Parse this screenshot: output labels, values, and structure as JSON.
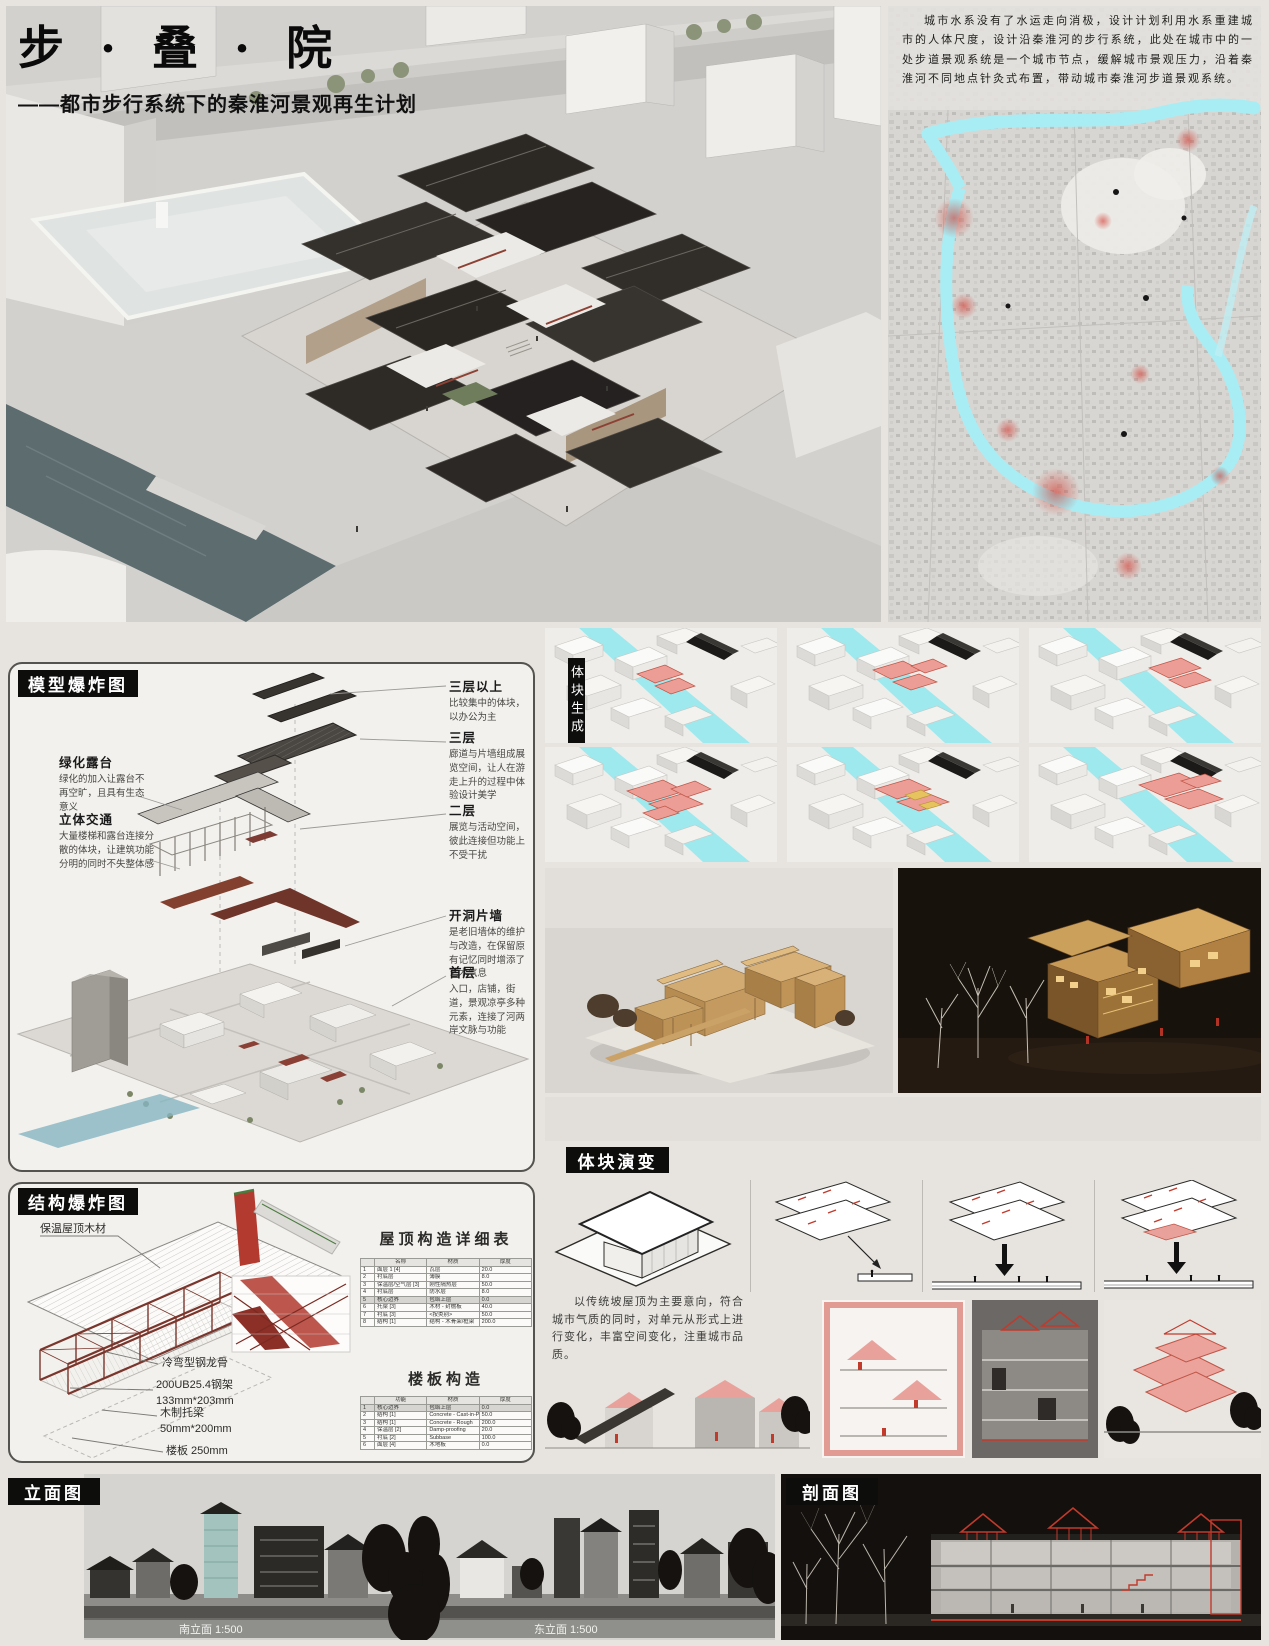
{
  "header": {
    "title": "步 · 叠 · 院",
    "subtitle": "——都市步行系统下的秦淮河景观再生计划"
  },
  "site": {
    "intro": "城市水系没有了水运走向消极，设计计划利用水系重建城市的人体尺度，设计沿秦淮河的步行系统，此处在城市中的一处步道景观系统是一个城市节点，缓解城市景观压力，沿着秦淮河不同地点针灸式布置，带动城市秦淮河步道景观系统。"
  },
  "exploded_model": {
    "title": "模型爆炸图",
    "left_labels": [
      {
        "title": "绿化露台",
        "desc": "绿化的加入让露台不再空旷，且具有生态意义"
      },
      {
        "title": "立体交通",
        "desc": "大量楼梯和露台连接分散的体块，让建筑功能分明的同时不失整体感"
      }
    ],
    "right_labels": [
      {
        "title": "三层以上",
        "desc": "比较集中的体块，以办公为主"
      },
      {
        "title": "三层",
        "desc": "廊道与片墙组成展览空间，让人在游走上升的过程中体验设计美学"
      },
      {
        "title": "二层",
        "desc": "展览与活动空间，彼此连接但功能上不受干扰"
      },
      {
        "title": "开洞片墙",
        "desc": "是老旧墙体的维护与改造，在保留原有记忆同时增添了艺术气息"
      },
      {
        "title": "首层",
        "desc": "入口，店铺，街道，景观凉亭多种元素，连接了河两岸文脉与功能"
      }
    ]
  },
  "massing_generation": {
    "title": "体块生成"
  },
  "massing_evolution": {
    "title": "体块演变",
    "note": "以传统坡屋顶为主要意向，符合城市气质的同时，对单元从形式上进行变化，丰富空间变化，注重城市品质。"
  },
  "structure": {
    "title": "结构爆炸图",
    "labels": {
      "roof_wood": "保温屋顶木材",
      "keel": "冷弯型钢龙骨",
      "frame_line1": "200UB25.4钢架",
      "frame_line2": "133mm*203mm",
      "joist_line1": "木制托梁",
      "joist_line2": "50mm*200mm",
      "slab": "楼板 250mm"
    },
    "roof_table": {
      "title": "屋顶构造详细表",
      "columns": [
        "",
        "名称",
        "材质",
        "厚度"
      ],
      "rows": [
        [
          "1",
          "面层 1 [4]",
          "瓦层",
          "20.0"
        ],
        [
          "2",
          "衬底层",
          "薄膜",
          "8.0"
        ],
        [
          "3",
          "保温层/空气层 [3]",
          "刚性隔热层",
          "50.0"
        ],
        [
          "4",
          "衬底层",
          "防水层",
          "8.0"
        ],
        [
          "5",
          "核心边界",
          "包络上层",
          "0.0"
        ],
        [
          "6",
          "托梁 [3]",
          "木材 - 封檐板",
          "40.0"
        ],
        [
          "7",
          "衬底 [3]",
          "<按类别>",
          "50.0"
        ],
        [
          "8",
          "结构 [1]",
          "结构 - 木骨架/框架",
          "200.0"
        ]
      ]
    },
    "floor_table": {
      "title": "楼板构造",
      "columns": [
        "",
        "功能",
        "材质",
        "厚度"
      ],
      "rows": [
        [
          "1",
          "核心边界",
          "包络上层",
          "0.0"
        ],
        [
          "2",
          "结构 [1]",
          "Concrete - Cast-in-Place",
          "50.0"
        ],
        [
          "3",
          "结构 [1]",
          "Concrete - Rough",
          "200.0"
        ],
        [
          "4",
          "保温层 [2]",
          "Damp-proofing",
          "20.0"
        ],
        [
          "5",
          "衬底 [2]",
          "Subbase",
          "100.0"
        ],
        [
          "6",
          "面层 [4]",
          "木地板",
          "0.0"
        ]
      ]
    }
  },
  "bottom": {
    "elevations": {
      "title": "立面图",
      "captions": [
        "南立面 1:500",
        "东立面 1:500"
      ]
    },
    "section": {
      "title": "剖面图"
    }
  },
  "colors": {
    "accent_red": "#b23a2e",
    "highlight_pink": "#ec9e96",
    "river_cyan": "#8fe7ef",
    "header_black": "#0d0d0c"
  }
}
